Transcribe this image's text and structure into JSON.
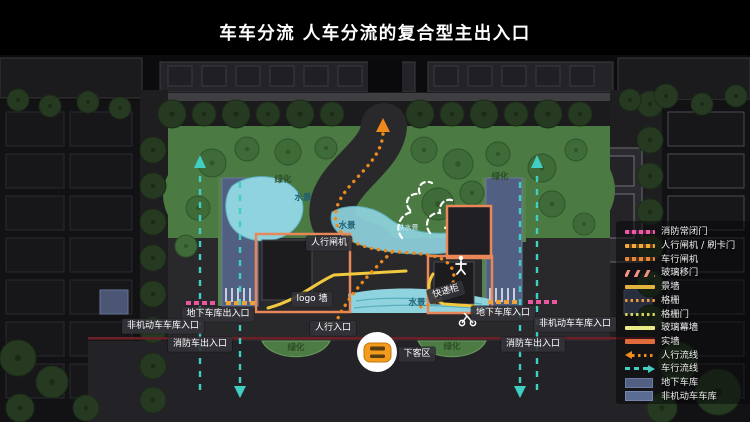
{
  "title": "车车分流 人车分流的复合型主出入口",
  "legend": {
    "items": [
      {
        "label": "消防常闭门"
      },
      {
        "label": "人行闸机 / 刷卡门"
      },
      {
        "label": "车行闸机"
      },
      {
        "label": "玻璃移门"
      },
      {
        "label": "景墙"
      },
      {
        "label": "格栅"
      },
      {
        "label": "格栅门"
      },
      {
        "label": "玻璃幕墙"
      },
      {
        "label": "实墙"
      },
      {
        "label": "人行流线"
      },
      {
        "label": "车行流线"
      },
      {
        "label": "地下车库"
      },
      {
        "label": "非机动车车库"
      }
    ]
  },
  "plan": {
    "labels": {
      "pedestrian_gate": "人行闸机",
      "logo_wall": "logo 墙",
      "pedestrian_entrance": "人行入口",
      "dropoff_zone": "下客区",
      "express_locker": "快递柜",
      "garage_entrance_right": "地下车库入口",
      "garage_entrance_left": "地下车库出入口",
      "nonmotor_garage_left": "非机动车车库入口",
      "nonmotor_garage_right": "非机动车车库入口",
      "fire_exit_left": "消防车出入口",
      "fire_exit_right": "消防车出入口"
    },
    "area_labels": {
      "green_top_left": "绿化",
      "green_top_right": "绿化",
      "green_bottom_left": "绿化",
      "green_bottom_right": "绿化",
      "water_1": "水景",
      "water_2": "水景",
      "water_3": "水景",
      "cascade": "跌水景"
    }
  },
  "colors": {
    "pedestrian_flow": "#ef8c1f",
    "vehicle_flow": "#42cfc3",
    "fire_door": "#ee5ba2",
    "gate": "#f2a93f",
    "glass_curtain": "#ebeb8a",
    "solid_wall": "#df6c3a",
    "underground_garage": "#516082",
    "green": "#4b7a43",
    "water": "#8ed3de"
  }
}
